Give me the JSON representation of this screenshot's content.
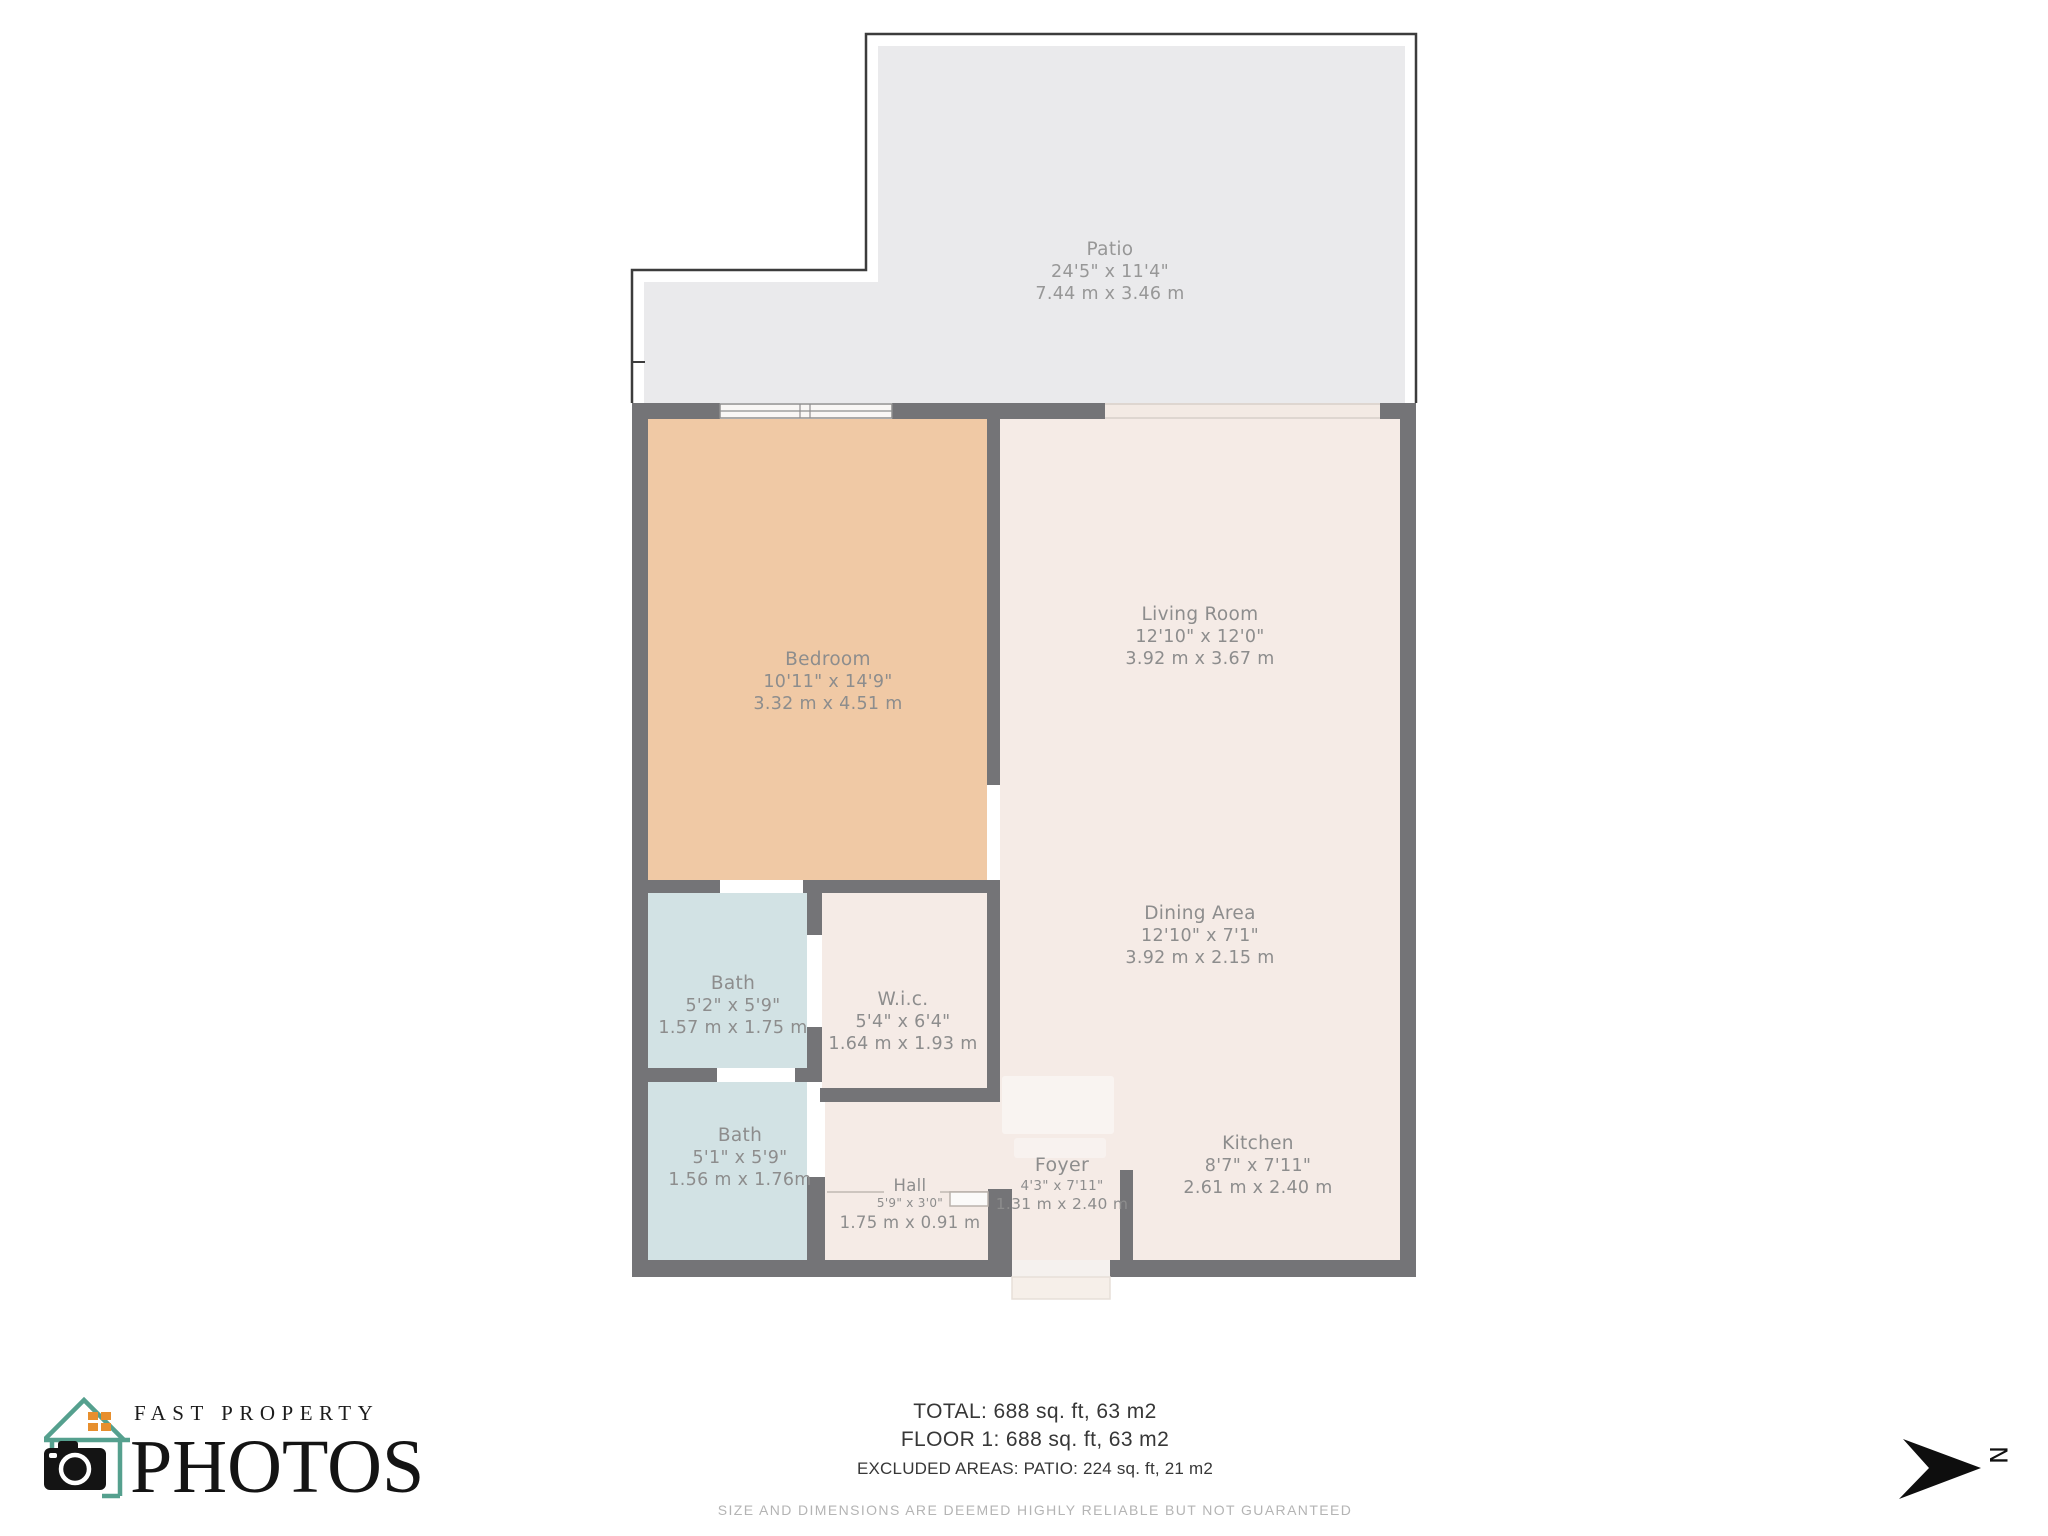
{
  "floorplan": {
    "rooms": [
      {
        "name": "Patio",
        "dims_ft": "24'5\" x 11'4\"",
        "dims_m": "7.44 m x 3.46 m"
      },
      {
        "name": "Bedroom",
        "dims_ft": "10'11\" x 14'9\"",
        "dims_m": "3.32 m x 4.51 m"
      },
      {
        "name": "Living Room",
        "dims_ft": "12'10\" x 12'0\"",
        "dims_m": "3.92 m x 3.67 m"
      },
      {
        "name": "Dining Area",
        "dims_ft": "12'10\" x 7'1\"",
        "dims_m": "3.92 m x 2.15 m"
      },
      {
        "name": "Bath",
        "dims_ft": "5'2\" x 5'9\"",
        "dims_m": "1.57 m x 1.75 m"
      },
      {
        "name": "W.i.c.",
        "dims_ft": "5'4\" x 6'4\"",
        "dims_m": "1.64 m x 1.93 m"
      },
      {
        "name": "Bath",
        "dims_ft": "5'1\" x 5'9\"",
        "dims_m": "1.56 m x 1.76m"
      },
      {
        "name": "Hall",
        "dims_ft": "5'9\" x 3'0\"",
        "dims_m": "1.75 m x 0.91 m"
      },
      {
        "name": "Foyer",
        "dims_ft": "4'3\" x 7'11\"",
        "dims_m": "1.31 m x 2.40 m"
      },
      {
        "name": "Kitchen",
        "dims_ft": "8'7\" x 7'11\"",
        "dims_m": "2.61 m x 2.40 m"
      }
    ],
    "summary": {
      "total": "TOTAL: 688 sq. ft, 63 m2",
      "floor1": "FLOOR 1: 688 sq. ft, 63 m2",
      "excluded": "EXCLUDED AREAS: PATIO: 224 sq. ft, 21 m2"
    },
    "disclaimer": "SIZE AND DIMENSIONS ARE DEEMED HIGHLY RELIABLE BUT NOT GUARANTEED",
    "compass": {
      "label": "N"
    },
    "logo": {
      "line1": "FAST PROPERTY",
      "line2": "PHOTOS"
    },
    "colors": {
      "wall": "#747477",
      "patio_fill": "#eaeaec",
      "bedroom_fill": "#f0c9a5",
      "living_fill": "#f5ebe6",
      "bath_fill": "#d2e2e4",
      "label_text": "#8d8d8d",
      "logo_teal": "#55a08e",
      "logo_orange": "#e78f2e"
    }
  }
}
